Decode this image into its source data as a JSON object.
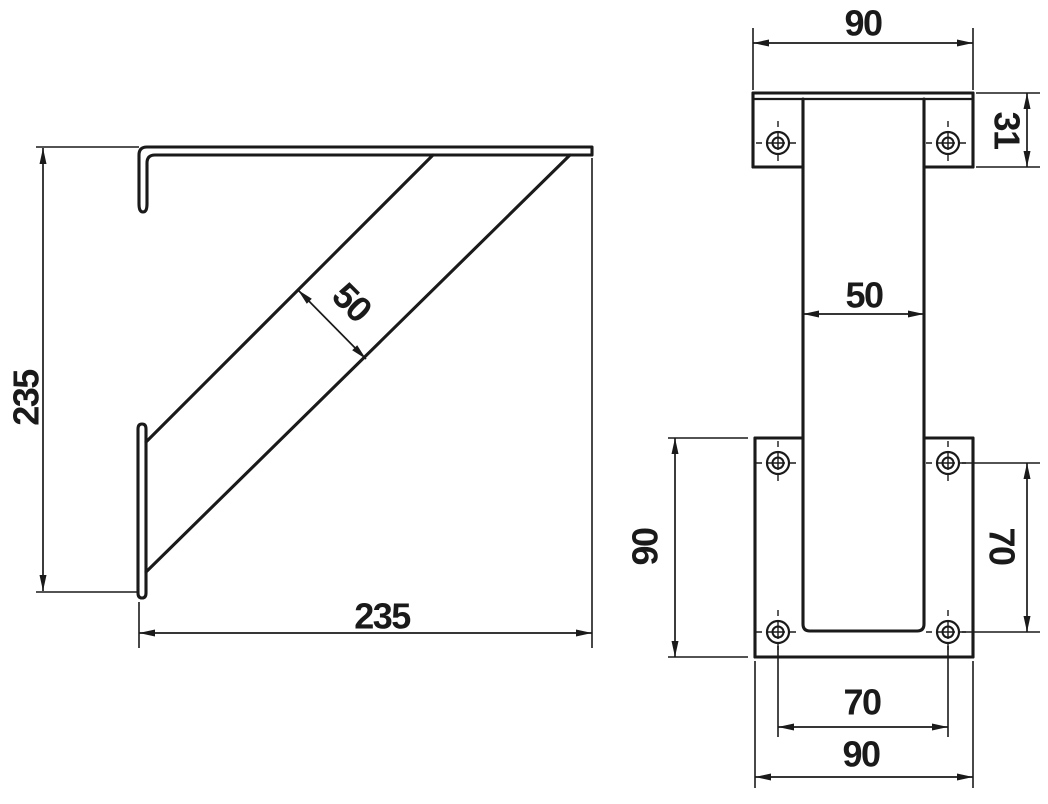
{
  "drawing": {
    "kind": "technical drawing",
    "subject": "wall shelf bracket, two orthographic views",
    "background_color": "#ffffff",
    "line_color": "#1a1a1a",
    "side_view": {
      "label": "side view",
      "dims": {
        "height": "235",
        "depth": "235",
        "strut_width": "50"
      }
    },
    "front_view": {
      "label": "front view",
      "dims": {
        "top_plate_width": "90",
        "top_plate_height": "31",
        "upright_width": "50",
        "plate_height_left": "90",
        "hole_pitch_vertical": "70",
        "hole_pitch_horizontal": "70",
        "bottom_plate_width": "90"
      }
    }
  }
}
